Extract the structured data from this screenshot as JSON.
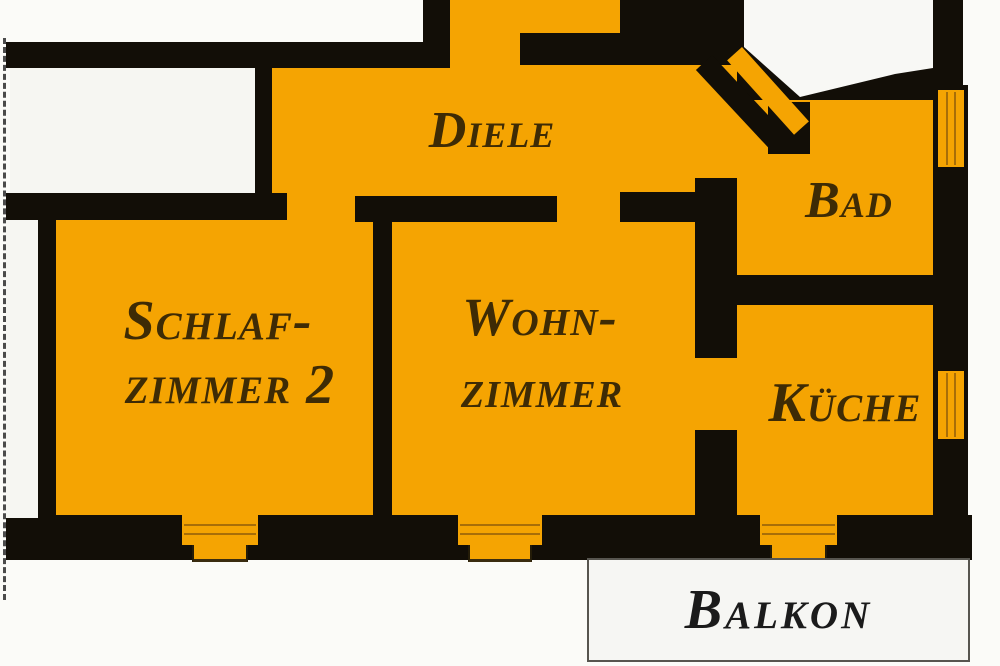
{
  "plan_type": "apartment-floor-plan",
  "colors": {
    "room_fill": "#F5A402",
    "wall": "#120E07",
    "label": "#3E2B05",
    "outside": "#F6F6F2",
    "balkon_label": "#1B1B1B"
  },
  "rooms": {
    "diele": {
      "label": "Diele"
    },
    "schlafzimmer2": {
      "line1": "Schlaf-",
      "line2": "zimmer 2"
    },
    "wohnzimmer": {
      "line1": "Wohn-",
      "line2": "zimmer"
    },
    "bad": {
      "label": "Bad"
    },
    "kueche": {
      "label": "Küche"
    },
    "balkon": {
      "label": "Balkon"
    }
  }
}
